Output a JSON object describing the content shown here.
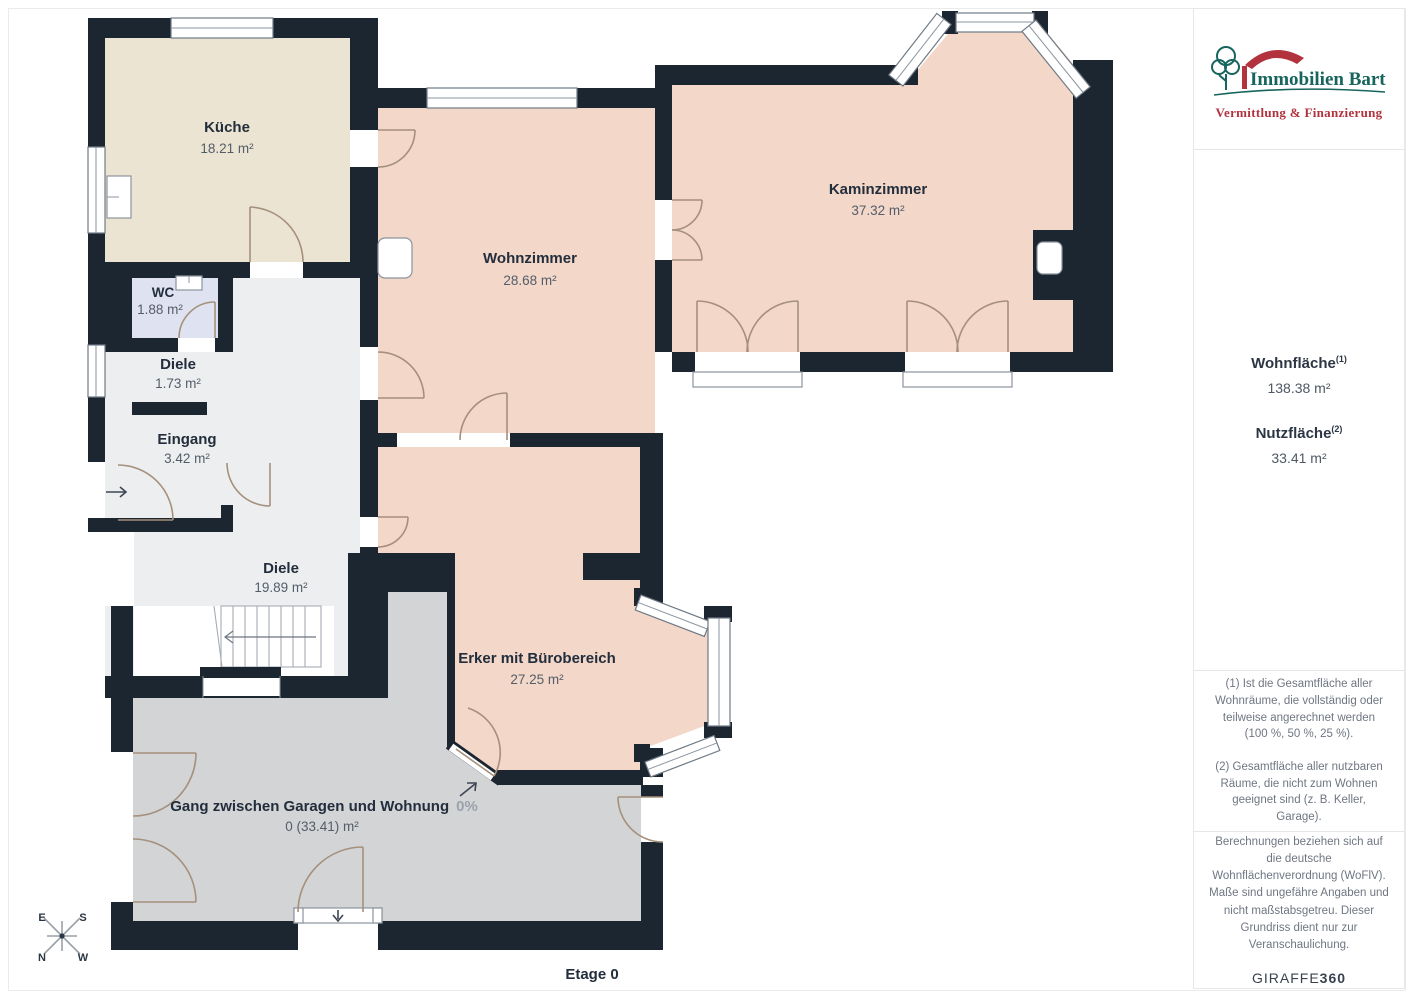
{
  "plan": {
    "floor_label": "Etage 0",
    "rooms": {
      "kueche": {
        "name": "Küche",
        "area": "18.21 m²"
      },
      "wc": {
        "name": "WC",
        "area": "1.88 m²"
      },
      "diele_klein": {
        "name": "Diele",
        "area": "1.73 m²"
      },
      "eingang": {
        "name": "Eingang",
        "area": "3.42 m²"
      },
      "diele": {
        "name": "Diele",
        "area": "19.89 m²"
      },
      "wohnzimmer": {
        "name": "Wohnzimmer",
        "area": "28.68 m²"
      },
      "kaminzimmer": {
        "name": "Kaminzimmer",
        "area": "37.32 m²"
      },
      "erker": {
        "name": "Erker mit Bürobereich",
        "area": "27.25 m²"
      },
      "gang": {
        "name": "Gang zwischen Garagen und Wohnung",
        "percent": "0%",
        "area": "0 (33.41) m²"
      }
    },
    "compass": {
      "e": "E",
      "s": "S",
      "n": "N",
      "w": "W"
    }
  },
  "sidebar": {
    "logo": {
      "title": "Immobilien Bart",
      "subtitle": "Vermittlung & Finanzierung"
    },
    "areas": {
      "wohnflaeche_label": "Wohnfläche",
      "wohnflaeche_sup": "(1)",
      "wohnflaeche_value": "138.38 m²",
      "nutzflaeche_label": "Nutzfläche",
      "nutzflaeche_sup": "(2)",
      "nutzflaeche_value": "33.41 m²"
    },
    "footnotes": {
      "note1": "(1) Ist die Gesamtfläche aller Wohnräume, die vollständig oder teilweise angerechnet werden (100 %, 50 %, 25 %).",
      "note2": "(2) Gesamtfläche aller nutzbaren Räume, die nicht zum Wohnen geeignet sind (z. B. Keller, Garage)."
    },
    "disclaimer": "Berechnungen beziehen sich auf die deutsche Wohnflächenverordnung (WoFlV). Maße sind ungefähre Angaben und nicht maßstabsgetreu. Dieser Grundriss dient nur zur Veranschaulichung.",
    "brand": {
      "giraffe": "GIRAFFE",
      "threesixty": "360"
    }
  },
  "colors": {
    "wall": "#1c2631",
    "room_living": "#f3d7c9",
    "room_kitchen": "#ece4d2",
    "room_wc": "#dfe3f1",
    "room_hall": "#edeef0",
    "room_gang": "#d3d4d6",
    "brand_green": "#17655d",
    "brand_red": "#b2333e"
  }
}
